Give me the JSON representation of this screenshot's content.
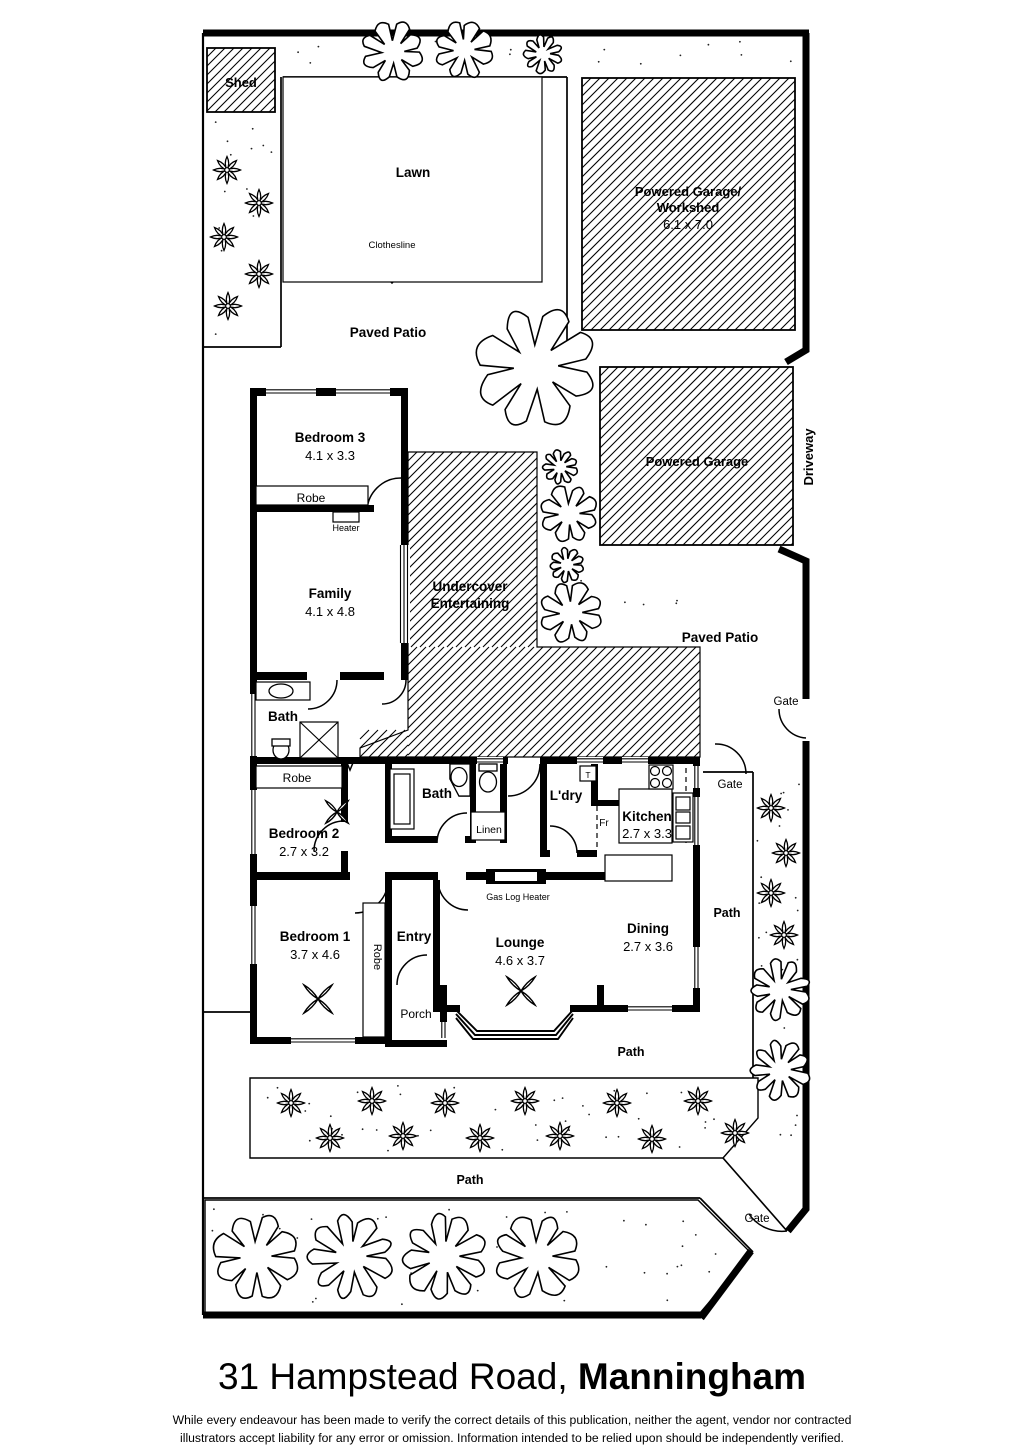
{
  "plan": {
    "outdoor": {
      "shed": "Shed",
      "lawn": "Lawn",
      "clothesline": "Clothesline",
      "paved_patio_top": "Paved Patio",
      "paved_patio_right": "Paved Patio",
      "driveway": "Driveway",
      "gate_right_top": "Gate",
      "gate_right_mid": "Gate",
      "gate_bottom": "Gate",
      "path_right": "Path",
      "path_mid": "Path",
      "path_bottom": "Path"
    },
    "structures": {
      "workshed_line1": "Powered Garage/",
      "workshed_line2": "Workshed",
      "workshed_dims": "6.1 x 7.0",
      "garage": "Powered Garage",
      "undercover_line1": "Undercover",
      "undercover_line2": "Entertaining"
    },
    "rooms": {
      "bedroom3_name": "Bedroom 3",
      "bedroom3_dims": "4.1 x 3.3",
      "robe_bed3": "Robe",
      "heater": "Heater",
      "family_name": "Family",
      "family_dims": "4.1 x 4.8",
      "bath_rear": "Bath",
      "robe_bed2": "Robe",
      "bedroom2_name": "Bedroom 2",
      "bedroom2_dims": "2.7 x 3.2",
      "bath_main": "Bath",
      "linen": "Linen",
      "laundry": "L'dry",
      "trough": "T",
      "fridge": "Fr",
      "kitchen_name": "Kitchen",
      "kitchen_dims": "2.7 x 3.3",
      "gas_log_heater": "Gas Log Heater",
      "bedroom1_name": "Bedroom 1",
      "bedroom1_dims": "3.7 x 4.6",
      "robe_bed1": "Robe",
      "entry": "Entry",
      "porch": "Porch",
      "lounge_name": "Lounge",
      "lounge_dims": "4.6 x 3.7",
      "dining_name": "Dining",
      "dining_dims": "2.7 x 3.6"
    }
  },
  "footer": {
    "address_regular": "31 Hampstead Road, ",
    "address_bold": "Manningham",
    "disclaimer_line1": "While every endeavour has been made to verify the correct details of this publication, neither the agent, vendor nor contracted",
    "disclaimer_line2": "illustrators accept liability for any error or omission. Information intended to be relied upon should be independently verified."
  }
}
